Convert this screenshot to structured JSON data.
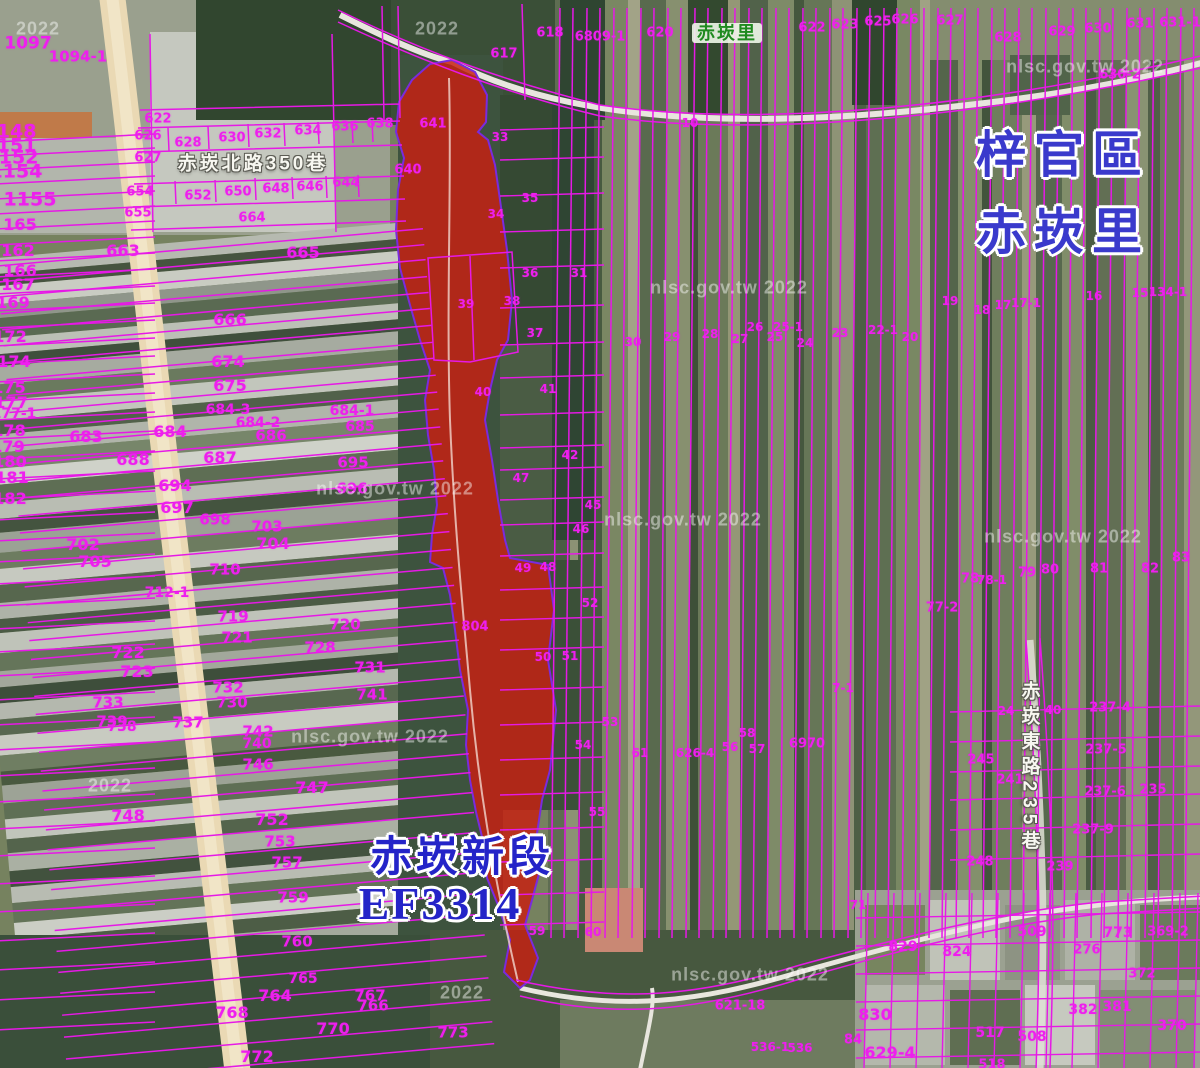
{
  "map": {
    "district_label": "梓官區",
    "village_label": "赤崁里",
    "village_badge": "赤崁里",
    "section_label": "赤崁新段",
    "section_code": "EF3314",
    "road_labels": [
      {
        "text": "赤崁北路350巷",
        "x": 253,
        "y": 164,
        "orientation": "horizontal"
      },
      {
        "text": "赤崁東路235巷",
        "x": 1029,
        "y": 768,
        "orientation": "vertical"
      }
    ],
    "colors": {
      "parcel_line": "#e619e6",
      "parcel_text": "#ee1fee",
      "highlight_fill": "#c62012",
      "label_blue": "#3a3acc",
      "village_green": "#1f8a1f",
      "watermark": "#ffffff"
    },
    "watermarks": [
      {
        "t": "2022",
        "x": 38,
        "y": 29
      },
      {
        "t": "2022",
        "x": 437,
        "y": 29
      },
      {
        "t": "nlsc.gov.tw 2022",
        "x": 1085,
        "y": 67
      },
      {
        "t": "nlsc.gov.tw 2022",
        "x": 729,
        "y": 288
      },
      {
        "t": "nlsc.gov.tw 2022",
        "x": 395,
        "y": 489
      },
      {
        "t": "nlsc.gov.tw 2022",
        "x": 683,
        "y": 520
      },
      {
        "t": "nlsc.gov.tw 2022",
        "x": 1063,
        "y": 537
      },
      {
        "t": "2022",
        "x": 110,
        "y": 786
      },
      {
        "t": "nlsc.gov.tw 2022",
        "x": 370,
        "y": 737
      },
      {
        "t": "nlsc.gov.tw 2022",
        "x": 750,
        "y": 975
      },
      {
        "t": "2022",
        "x": 462,
        "y": 993
      }
    ],
    "parcel_numbers": [
      {
        "t": "1097",
        "x": 28,
        "y": 44,
        "s": 17
      },
      {
        "t": "1094-1",
        "x": 78,
        "y": 57,
        "s": 15
      },
      {
        "t": "622",
        "x": 158,
        "y": 119
      },
      {
        "t": "626",
        "x": 148,
        "y": 136
      },
      {
        "t": "628",
        "x": 188,
        "y": 143
      },
      {
        "t": "630",
        "x": 232,
        "y": 138
      },
      {
        "t": "632",
        "x": 268,
        "y": 134
      },
      {
        "t": "634",
        "x": 308,
        "y": 131
      },
      {
        "t": "636",
        "x": 345,
        "y": 127
      },
      {
        "t": "638",
        "x": 380,
        "y": 124
      },
      {
        "t": "627",
        "x": 148,
        "y": 158
      },
      {
        "t": "654",
        "x": 140,
        "y": 192
      },
      {
        "t": "652",
        "x": 198,
        "y": 196
      },
      {
        "t": "650",
        "x": 238,
        "y": 192
      },
      {
        "t": "648",
        "x": 276,
        "y": 189
      },
      {
        "t": "646",
        "x": 310,
        "y": 187
      },
      {
        "t": "644",
        "x": 346,
        "y": 183
      },
      {
        "t": "655",
        "x": 138,
        "y": 213
      },
      {
        "t": "664",
        "x": 252,
        "y": 218
      },
      {
        "t": "641",
        "x": 433,
        "y": 124
      },
      {
        "t": "640",
        "x": 408,
        "y": 170
      },
      {
        "t": "1148",
        "x": 10,
        "y": 132,
        "s": 19
      },
      {
        "t": "1151",
        "x": 10,
        "y": 146,
        "s": 19
      },
      {
        "t": "1152",
        "x": 12,
        "y": 158,
        "s": 19
      },
      {
        "t": "1154",
        "x": 16,
        "y": 172,
        "s": 19
      },
      {
        "t": "1155",
        "x": 30,
        "y": 200,
        "s": 19
      },
      {
        "t": "165",
        "x": 20,
        "y": 225,
        "s": 16
      },
      {
        "t": "162",
        "x": 18,
        "y": 251,
        "s": 16
      },
      {
        "t": "166",
        "x": 20,
        "y": 271,
        "s": 16
      },
      {
        "t": "167",
        "x": 18,
        "y": 285,
        "s": 16
      },
      {
        "t": "169",
        "x": 13,
        "y": 303,
        "s": 16
      },
      {
        "t": "172",
        "x": 10,
        "y": 337,
        "s": 16
      },
      {
        "t": "174",
        "x": 14,
        "y": 362,
        "s": 16
      },
      {
        "t": "175",
        "x": 9,
        "y": 388,
        "s": 16
      },
      {
        "t": "177",
        "x": 11,
        "y": 403,
        "s": 16
      },
      {
        "t": "177-1",
        "x": 14,
        "y": 414,
        "s": 14
      },
      {
        "t": "178",
        "x": 9,
        "y": 431,
        "s": 16
      },
      {
        "t": "179",
        "x": 8,
        "y": 447,
        "s": 16
      },
      {
        "t": "180",
        "x": 10,
        "y": 462,
        "s": 16
      },
      {
        "t": "181",
        "x": 12,
        "y": 478,
        "s": 16
      },
      {
        "t": "182",
        "x": 10,
        "y": 499,
        "s": 16
      },
      {
        "t": "663",
        "x": 123,
        "y": 251,
        "s": 16
      },
      {
        "t": "665",
        "x": 303,
        "y": 253,
        "s": 16
      },
      {
        "t": "666",
        "x": 230,
        "y": 320,
        "s": 16
      },
      {
        "t": "674",
        "x": 228,
        "y": 362,
        "s": 16
      },
      {
        "t": "675",
        "x": 230,
        "y": 386,
        "s": 16
      },
      {
        "t": "684-3",
        "x": 228,
        "y": 410,
        "s": 14
      },
      {
        "t": "684-2",
        "x": 258,
        "y": 423,
        "s": 14
      },
      {
        "t": "684-1",
        "x": 352,
        "y": 411,
        "s": 14
      },
      {
        "t": "685",
        "x": 360,
        "y": 427,
        "s": 14
      },
      {
        "t": "684",
        "x": 170,
        "y": 432,
        "s": 16
      },
      {
        "t": "686",
        "x": 271,
        "y": 436,
        "s": 15
      },
      {
        "t": "683",
        "x": 86,
        "y": 437,
        "s": 16
      },
      {
        "t": "688",
        "x": 133,
        "y": 460,
        "s": 16
      },
      {
        "t": "687",
        "x": 220,
        "y": 458,
        "s": 16
      },
      {
        "t": "695",
        "x": 353,
        "y": 463,
        "s": 15
      },
      {
        "t": "694",
        "x": 175,
        "y": 486,
        "s": 16
      },
      {
        "t": "696",
        "x": 352,
        "y": 489,
        "s": 15
      },
      {
        "t": "697",
        "x": 177,
        "y": 508,
        "s": 16
      },
      {
        "t": "698",
        "x": 215,
        "y": 520,
        "s": 15
      },
      {
        "t": "703",
        "x": 267,
        "y": 527,
        "s": 15
      },
      {
        "t": "704",
        "x": 273,
        "y": 544,
        "s": 16
      },
      {
        "t": "702",
        "x": 83,
        "y": 545,
        "s": 16
      },
      {
        "t": "705",
        "x": 95,
        "y": 562,
        "s": 16
      },
      {
        "t": "710",
        "x": 225,
        "y": 570,
        "s": 15
      },
      {
        "t": "712-1",
        "x": 167,
        "y": 593,
        "s": 14
      },
      {
        "t": "719",
        "x": 233,
        "y": 617,
        "s": 15
      },
      {
        "t": "720",
        "x": 345,
        "y": 625,
        "s": 15
      },
      {
        "t": "721",
        "x": 237,
        "y": 638,
        "s": 15
      },
      {
        "t": "728",
        "x": 320,
        "y": 648,
        "s": 15
      },
      {
        "t": "722",
        "x": 128,
        "y": 653,
        "s": 16
      },
      {
        "t": "723",
        "x": 137,
        "y": 672,
        "s": 16
      },
      {
        "t": "731",
        "x": 370,
        "y": 668,
        "s": 15
      },
      {
        "t": "732",
        "x": 228,
        "y": 688,
        "s": 15
      },
      {
        "t": "741",
        "x": 372,
        "y": 695,
        "s": 15
      },
      {
        "t": "733",
        "x": 108,
        "y": 703,
        "s": 15
      },
      {
        "t": "730",
        "x": 232,
        "y": 703,
        "s": 15
      },
      {
        "t": "739",
        "x": 112,
        "y": 722,
        "s": 15
      },
      {
        "t": "738",
        "x": 122,
        "y": 727,
        "s": 14
      },
      {
        "t": "737",
        "x": 188,
        "y": 723,
        "s": 15
      },
      {
        "t": "742",
        "x": 258,
        "y": 732,
        "s": 15
      },
      {
        "t": "740",
        "x": 257,
        "y": 744,
        "s": 14
      },
      {
        "t": "746",
        "x": 258,
        "y": 765,
        "s": 15
      },
      {
        "t": "747",
        "x": 312,
        "y": 788,
        "s": 16
      },
      {
        "t": "748",
        "x": 128,
        "y": 816,
        "s": 16
      },
      {
        "t": "752",
        "x": 272,
        "y": 820,
        "s": 16
      },
      {
        "t": "753",
        "x": 280,
        "y": 842,
        "s": 15
      },
      {
        "t": "757",
        "x": 287,
        "y": 863,
        "s": 15
      },
      {
        "t": "759",
        "x": 293,
        "y": 898,
        "s": 15
      },
      {
        "t": "760",
        "x": 297,
        "y": 942,
        "s": 15
      },
      {
        "t": "765",
        "x": 303,
        "y": 979,
        "s": 14
      },
      {
        "t": "764",
        "x": 275,
        "y": 996,
        "s": 16
      },
      {
        "t": "767",
        "x": 370,
        "y": 996,
        "s": 15
      },
      {
        "t": "766",
        "x": 373,
        "y": 1006,
        "s": 15
      },
      {
        "t": "768",
        "x": 232,
        "y": 1013,
        "s": 16
      },
      {
        "t": "770",
        "x": 333,
        "y": 1029,
        "s": 16
      },
      {
        "t": "772",
        "x": 257,
        "y": 1057,
        "s": 16
      },
      {
        "t": "773",
        "x": 453,
        "y": 1033,
        "s": 15
      },
      {
        "t": "617",
        "x": 504,
        "y": 54
      },
      {
        "t": "618",
        "x": 550,
        "y": 33
      },
      {
        "t": "6809-1",
        "x": 600,
        "y": 37
      },
      {
        "t": "620",
        "x": 660,
        "y": 33
      },
      {
        "t": "10",
        "x": 690,
        "y": 123,
        "s": 12
      },
      {
        "t": "33",
        "x": 500,
        "y": 137,
        "s": 12
      },
      {
        "t": "34",
        "x": 496,
        "y": 214,
        "s": 12
      },
      {
        "t": "35",
        "x": 530,
        "y": 198,
        "s": 12
      },
      {
        "t": "36",
        "x": 530,
        "y": 273,
        "s": 12
      },
      {
        "t": "31",
        "x": 579,
        "y": 273,
        "s": 12
      },
      {
        "t": "39",
        "x": 466,
        "y": 304,
        "s": 12
      },
      {
        "t": "38",
        "x": 512,
        "y": 301,
        "s": 12
      },
      {
        "t": "37",
        "x": 535,
        "y": 333,
        "s": 12
      },
      {
        "t": "30",
        "x": 633,
        "y": 342,
        "s": 12
      },
      {
        "t": "29",
        "x": 672,
        "y": 337,
        "s": 12
      },
      {
        "t": "28",
        "x": 710,
        "y": 334,
        "s": 12
      },
      {
        "t": "27",
        "x": 740,
        "y": 339,
        "s": 12
      },
      {
        "t": "26",
        "x": 755,
        "y": 327,
        "s": 12
      },
      {
        "t": "25-1",
        "x": 788,
        "y": 327,
        "s": 12
      },
      {
        "t": "25",
        "x": 775,
        "y": 337,
        "s": 12
      },
      {
        "t": "24",
        "x": 805,
        "y": 343,
        "s": 12
      },
      {
        "t": "23",
        "x": 840,
        "y": 333,
        "s": 12
      },
      {
        "t": "22-1",
        "x": 883,
        "y": 330,
        "s": 12
      },
      {
        "t": "20",
        "x": 910,
        "y": 337,
        "s": 12
      },
      {
        "t": "19",
        "x": 950,
        "y": 301,
        "s": 12
      },
      {
        "t": "18",
        "x": 982,
        "y": 310,
        "s": 12
      },
      {
        "t": "17",
        "x": 1003,
        "y": 305,
        "s": 12
      },
      {
        "t": "17-1",
        "x": 1026,
        "y": 303,
        "s": 12
      },
      {
        "t": "16",
        "x": 1094,
        "y": 296,
        "s": 12
      },
      {
        "t": "15",
        "x": 1140,
        "y": 293,
        "s": 12
      },
      {
        "t": "134-1",
        "x": 1168,
        "y": 292,
        "s": 12
      },
      {
        "t": "40",
        "x": 483,
        "y": 392,
        "s": 12
      },
      {
        "t": "41",
        "x": 548,
        "y": 389,
        "s": 12
      },
      {
        "t": "42",
        "x": 570,
        "y": 455,
        "s": 12
      },
      {
        "t": "47",
        "x": 521,
        "y": 478,
        "s": 12
      },
      {
        "t": "45",
        "x": 593,
        "y": 505,
        "s": 12
      },
      {
        "t": "46",
        "x": 581,
        "y": 529,
        "s": 12
      },
      {
        "t": "49",
        "x": 523,
        "y": 568,
        "s": 12
      },
      {
        "t": "48",
        "x": 548,
        "y": 567,
        "s": 12
      },
      {
        "t": "52",
        "x": 590,
        "y": 603,
        "s": 12
      },
      {
        "t": "50",
        "x": 543,
        "y": 657,
        "s": 12
      },
      {
        "t": "51",
        "x": 570,
        "y": 656,
        "s": 12
      },
      {
        "t": "804",
        "x": 475,
        "y": 627
      },
      {
        "t": "53",
        "x": 610,
        "y": 722,
        "s": 12
      },
      {
        "t": "54",
        "x": 583,
        "y": 745,
        "s": 12
      },
      {
        "t": "55",
        "x": 597,
        "y": 812,
        "s": 12
      },
      {
        "t": "61",
        "x": 640,
        "y": 753,
        "s": 12
      },
      {
        "t": "626-4",
        "x": 695,
        "y": 753,
        "s": 12
      },
      {
        "t": "58",
        "x": 747,
        "y": 733,
        "s": 12
      },
      {
        "t": "56",
        "x": 730,
        "y": 747,
        "s": 12
      },
      {
        "t": "57",
        "x": 757,
        "y": 749,
        "s": 12
      },
      {
        "t": "6970",
        "x": 807,
        "y": 744
      },
      {
        "t": "7-1",
        "x": 843,
        "y": 688,
        "s": 12
      },
      {
        "t": "59",
        "x": 537,
        "y": 931,
        "s": 12
      },
      {
        "t": "60",
        "x": 593,
        "y": 932,
        "s": 12
      },
      {
        "t": "621-18",
        "x": 740,
        "y": 1006
      },
      {
        "t": "536-1",
        "x": 770,
        "y": 1047,
        "s": 12
      },
      {
        "t": "536",
        "x": 800,
        "y": 1048,
        "s": 12
      },
      {
        "t": "77-2",
        "x": 942,
        "y": 608
      },
      {
        "t": "78",
        "x": 970,
        "y": 579
      },
      {
        "t": "78-1",
        "x": 992,
        "y": 580,
        "s": 12
      },
      {
        "t": "79",
        "x": 1027,
        "y": 573
      },
      {
        "t": "80",
        "x": 1050,
        "y": 570
      },
      {
        "t": "81",
        "x": 1099,
        "y": 569
      },
      {
        "t": "82",
        "x": 1150,
        "y": 569
      },
      {
        "t": "83",
        "x": 1181,
        "y": 558
      },
      {
        "t": "24",
        "x": 1006,
        "y": 711,
        "s": 12
      },
      {
        "t": "40",
        "x": 1053,
        "y": 710,
        "s": 12
      },
      {
        "t": "237-4",
        "x": 1110,
        "y": 708
      },
      {
        "t": "245",
        "x": 981,
        "y": 760
      },
      {
        "t": "241",
        "x": 1010,
        "y": 780
      },
      {
        "t": "237-5",
        "x": 1106,
        "y": 750
      },
      {
        "t": "237-6",
        "x": 1105,
        "y": 792
      },
      {
        "t": "235",
        "x": 1153,
        "y": 790
      },
      {
        "t": "237-9",
        "x": 1093,
        "y": 830
      },
      {
        "t": "248",
        "x": 980,
        "y": 862
      },
      {
        "t": "239",
        "x": 1060,
        "y": 867
      },
      {
        "t": "71",
        "x": 858,
        "y": 905,
        "s": 12
      },
      {
        "t": "829",
        "x": 903,
        "y": 947,
        "s": 14
      },
      {
        "t": "824",
        "x": 957,
        "y": 952,
        "s": 14
      },
      {
        "t": "509",
        "x": 1032,
        "y": 932,
        "s": 14
      },
      {
        "t": "773",
        "x": 1118,
        "y": 933,
        "s": 14
      },
      {
        "t": "369-2",
        "x": 1168,
        "y": 932
      },
      {
        "t": "276",
        "x": 1087,
        "y": 950
      },
      {
        "t": "372",
        "x": 1142,
        "y": 974
      },
      {
        "t": "830",
        "x": 875,
        "y": 1015,
        "s": 16
      },
      {
        "t": "382",
        "x": 1083,
        "y": 1010,
        "s": 14
      },
      {
        "t": "381",
        "x": 1117,
        "y": 1007,
        "s": 14
      },
      {
        "t": "370",
        "x": 1172,
        "y": 1026,
        "s": 14
      },
      {
        "t": "517",
        "x": 990,
        "y": 1033,
        "s": 14
      },
      {
        "t": "508",
        "x": 1032,
        "y": 1037,
        "s": 14
      },
      {
        "t": "629-4",
        "x": 890,
        "y": 1053,
        "s": 16
      },
      {
        "t": "518",
        "x": 992,
        "y": 1065
      },
      {
        "t": "84",
        "x": 853,
        "y": 1040
      },
      {
        "t": "622",
        "x": 812,
        "y": 28
      },
      {
        "t": "623",
        "x": 845,
        "y": 25
      },
      {
        "t": "625",
        "x": 878,
        "y": 22
      },
      {
        "t": "626",
        "x": 905,
        "y": 20
      },
      {
        "t": "627",
        "x": 950,
        "y": 21
      },
      {
        "t": "628",
        "x": 1008,
        "y": 38
      },
      {
        "t": "629",
        "x": 1062,
        "y": 32
      },
      {
        "t": "630",
        "x": 1098,
        "y": 29
      },
      {
        "t": "631",
        "x": 1140,
        "y": 24
      },
      {
        "t": "631-1",
        "x": 1180,
        "y": 23
      },
      {
        "t": "630-2",
        "x": 1120,
        "y": 75
      }
    ]
  }
}
